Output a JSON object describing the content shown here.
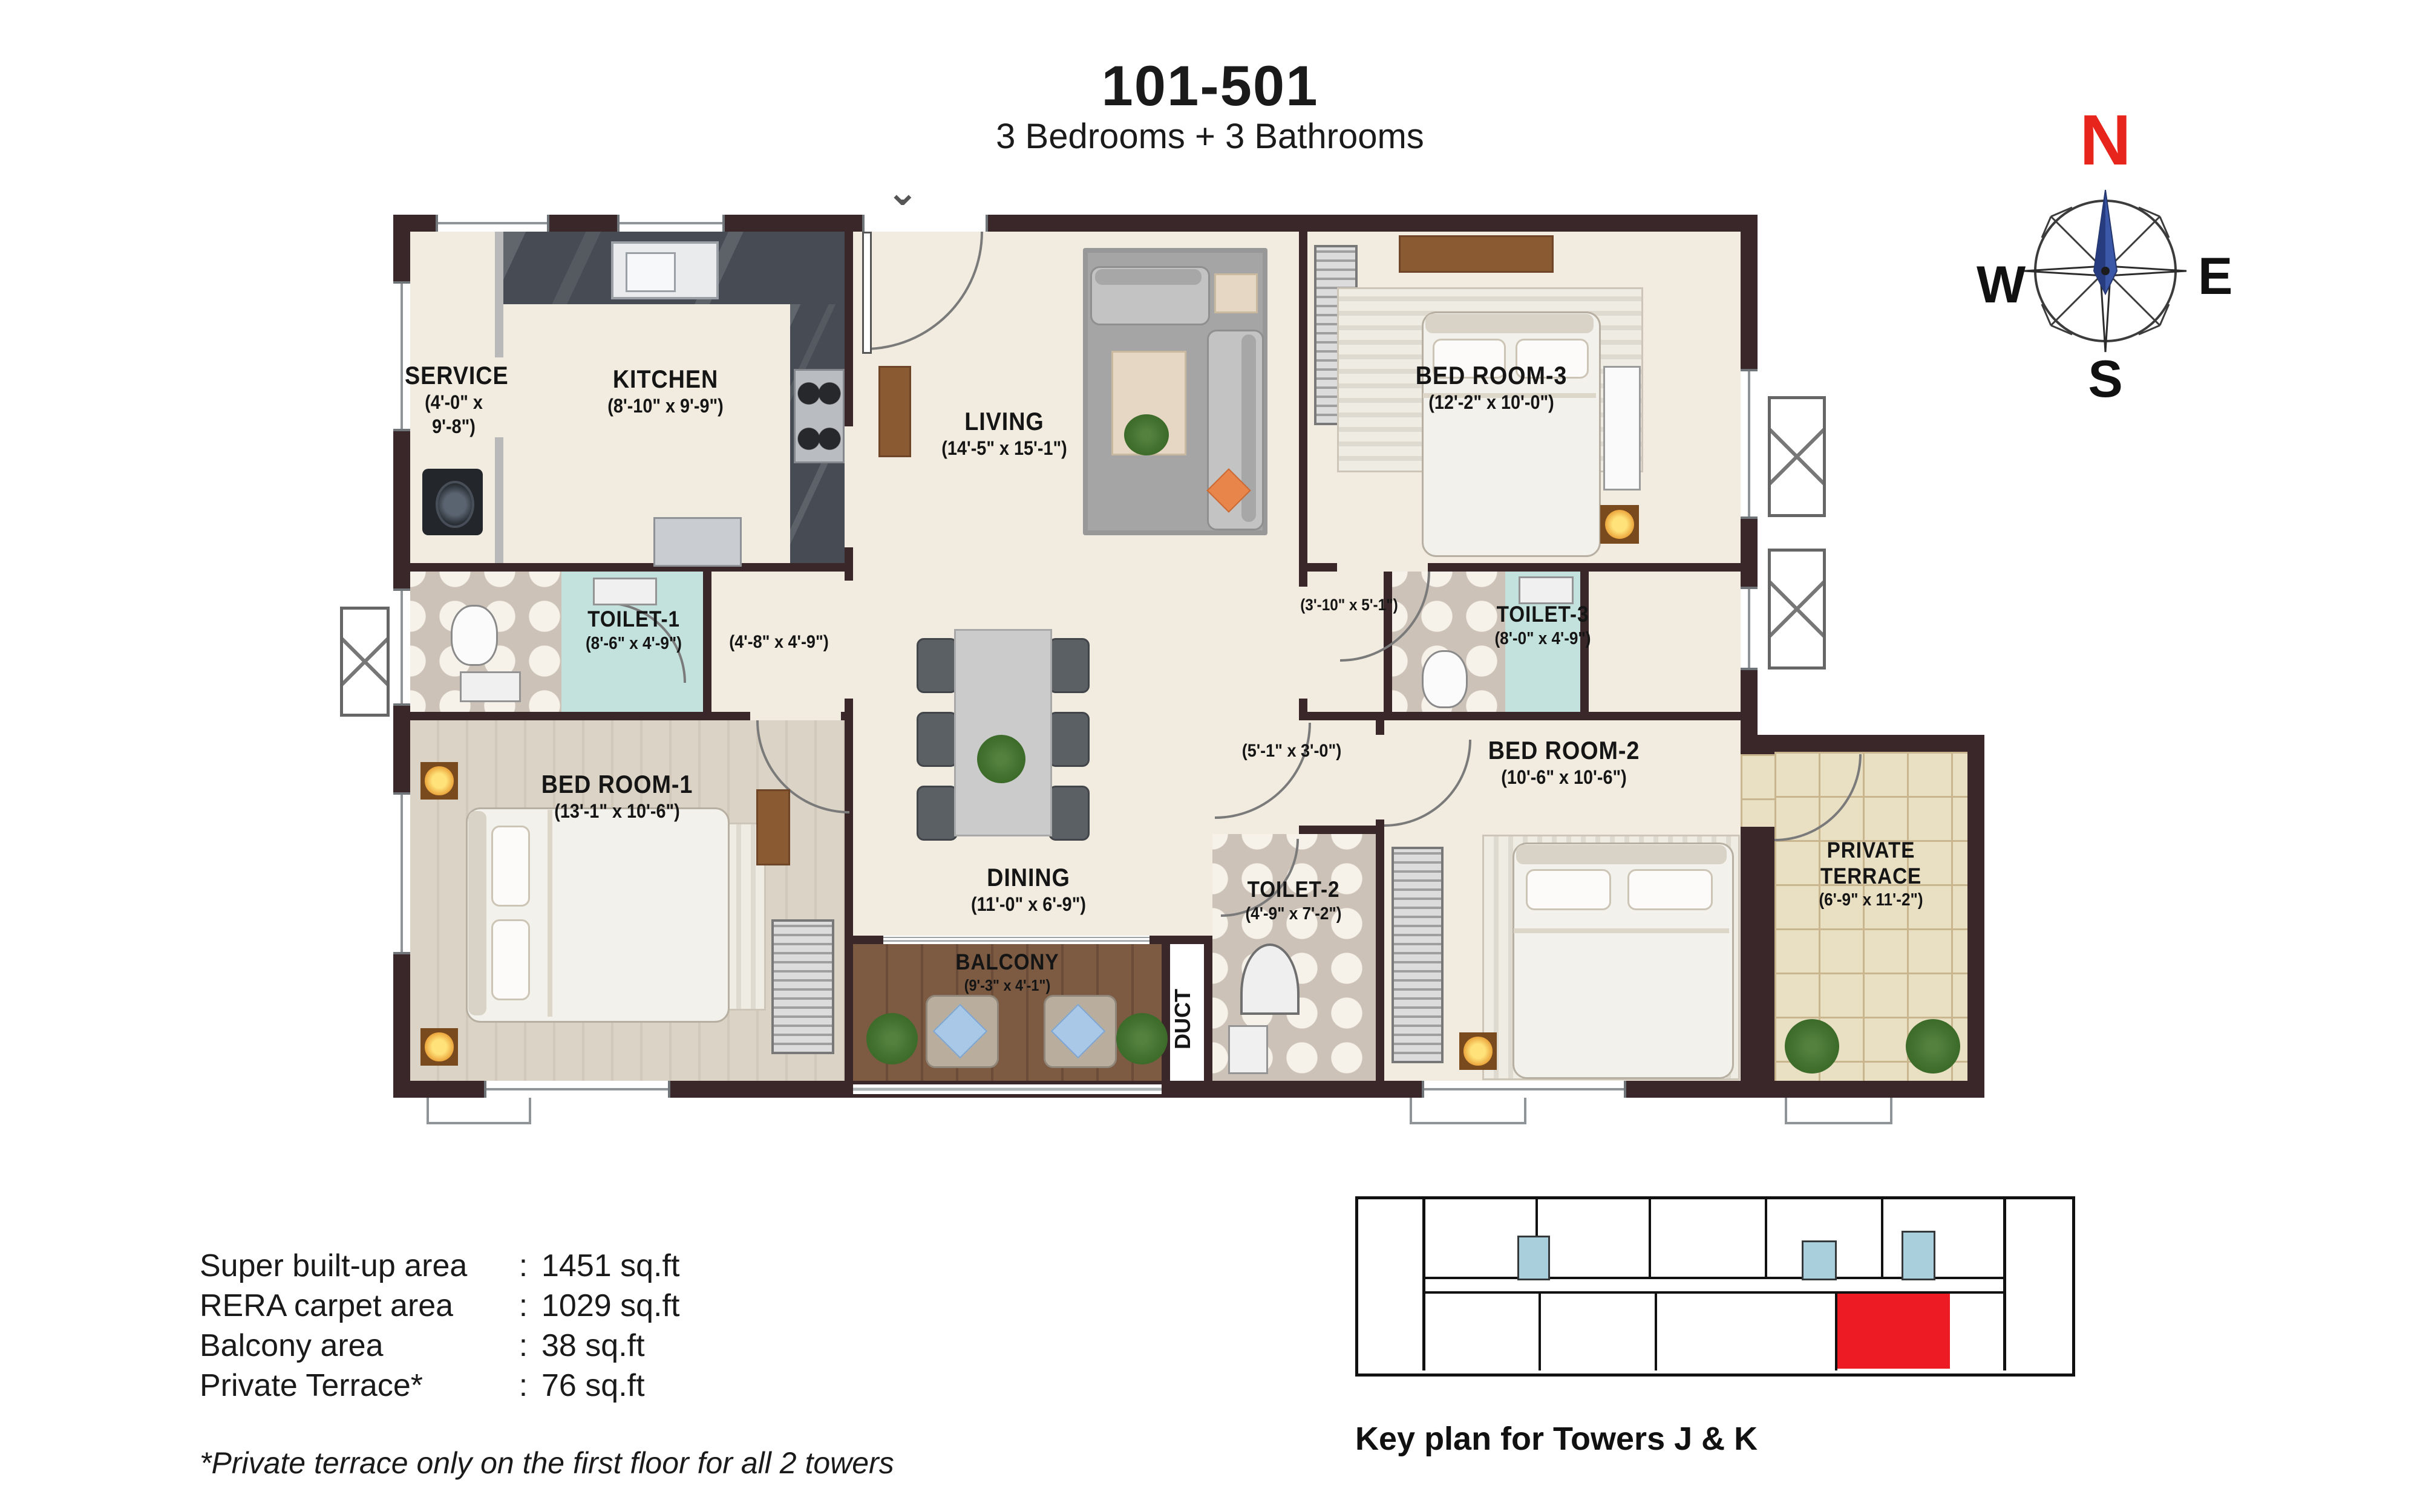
{
  "title": "101-501",
  "subtitle": "3 Bedrooms + 3 Bathrooms",
  "compass": {
    "n": "N",
    "e": "E",
    "s": "S",
    "w": "W"
  },
  "colors": {
    "wall": "#3a272a",
    "toilet_cyan": "#c3e2dd",
    "keyplan_highlight": "#ed1c24",
    "keyplan_core": "#a9cfdd",
    "north_red": "#e8251d",
    "needle_blue": "#3a57a8"
  },
  "rooms": {
    "service": {
      "name": "SERVICE",
      "dims": "(4'-0\" x 9'-8\")"
    },
    "kitchen": {
      "name": "KITCHEN",
      "dims": "(8'-10\" x 9'-9\")"
    },
    "living": {
      "name": "LIVING",
      "dims": "(14'-5\" x 15'-1\")"
    },
    "bedroom3": {
      "name": "BED ROOM-3",
      "dims": "(12'-2\" x 10'-0\")"
    },
    "toilet1": {
      "name": "TOILET-1",
      "dims": "(8'-6\" x 4'-9\")"
    },
    "passage1": {
      "dims": "(4'-8\" x 4'-9\")"
    },
    "lobby": {
      "dims": "(3'-10\" x 5'-1\")"
    },
    "toilet3": {
      "name": "TOILET-3",
      "dims": "(8'-0\" x 4'-9\")"
    },
    "bedroom1": {
      "name": "BED ROOM-1",
      "dims": "(13'-1\" x 10'-6\")"
    },
    "passage2": {
      "dims": "(5'-1\" x 3'-0\")"
    },
    "bedroom2": {
      "name": "BED ROOM-2",
      "dims": "(10'-6\" x 10'-6\")"
    },
    "dining": {
      "name": "DINING",
      "dims": "(11'-0\" x 6'-9\")"
    },
    "toilet2": {
      "name": "TOILET-2",
      "dims": "(4'-9\" x 7'-2\")"
    },
    "balcony": {
      "name": "BALCONY",
      "dims": "(9'-3\" x 4'-1\")"
    },
    "duct": {
      "name": "DUCT"
    },
    "terrace": {
      "line1": "PRIVATE",
      "line2": "TERRACE",
      "dims": "(6'-9\" x 11'-2\")"
    }
  },
  "areas": {
    "separator": ":",
    "rows": [
      {
        "label": "Super built-up area",
        "value": "1451 sq.ft"
      },
      {
        "label": "RERA carpet area",
        "value": "1029 sq.ft"
      },
      {
        "label": "Balcony area",
        "value": "38 sq.ft"
      },
      {
        "label": "Private Terrace*",
        "value": "76 sq.ft"
      }
    ],
    "note": "*Private terrace only on the first floor for all 2 towers"
  },
  "keyplan": {
    "caption": "Key plan for Towers J & K"
  }
}
